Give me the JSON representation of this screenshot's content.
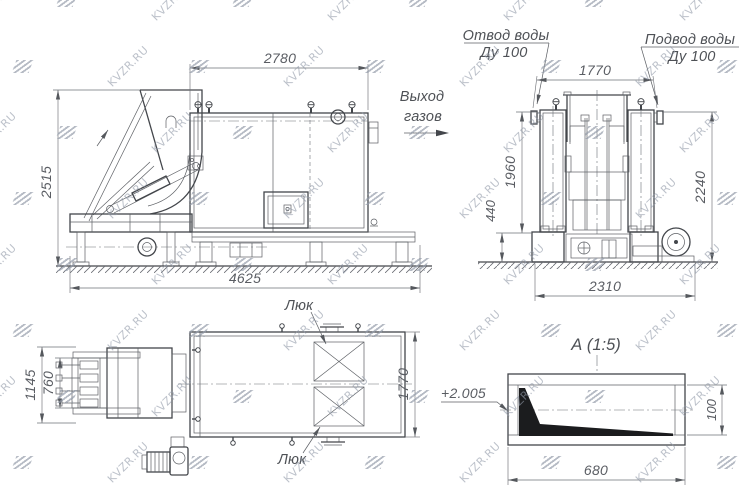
{
  "watermark": {
    "text": "KVZR.RU"
  },
  "side_view": {
    "dim_width": "2780",
    "dim_height": "2515",
    "dim_length": "4625"
  },
  "front_view": {
    "outlet_label": {
      "line1": "Отвод воды",
      "line2": "Ду 100"
    },
    "inlet_label": {
      "line1": "Подвод воды",
      "line2": "Ду 100"
    },
    "gas_label": {
      "line1": "Выход",
      "line2": "газов"
    },
    "dim_width_top": "1770",
    "dim_height_upper": "1960",
    "dim_height_lower": "440",
    "dim_height_right": "2240",
    "dim_width_bottom": "2310"
  },
  "plan_view": {
    "dim_height_outer": "1145",
    "dim_height_inner": "760",
    "dim_height_right": "1770",
    "hatch_label_top": "Люк",
    "hatch_label_bottom": "Люк"
  },
  "detail_view": {
    "title": "А (1:5)",
    "elevation": "+2.005",
    "dim_width": "680",
    "dim_height": "100"
  },
  "colors": {
    "line_main": "#43464b",
    "line_thin": "#5c5f64",
    "dim_text": "#5a5d63",
    "watermark": "#939BA9",
    "background": "#ffffff"
  }
}
